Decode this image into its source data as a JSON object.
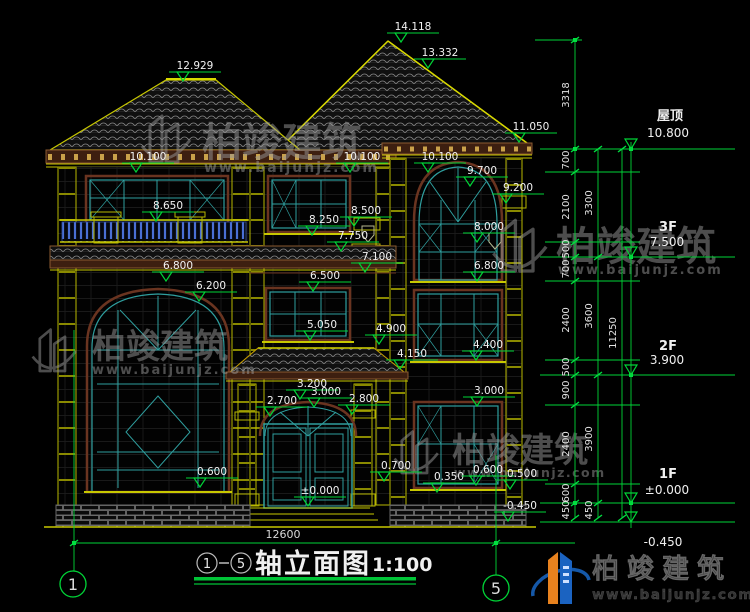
{
  "drawing": {
    "title": "轴立面图",
    "scale": "1:100",
    "axis_start": "1",
    "axis_end": "5",
    "total_width": "12600"
  },
  "levels": [
    {
      "name": "屋顶",
      "value": "10.800"
    },
    {
      "name": "3F",
      "value": "7.500"
    },
    {
      "name": "2F",
      "value": "3.900"
    },
    {
      "name": "1F",
      "value": "±0.000"
    },
    {
      "name": "",
      "value": "-0.450"
    }
  ],
  "markers": [
    "12.929",
    "14.118",
    "13.332",
    "11.050",
    "10.100",
    "10.100",
    "10.100",
    "9.700",
    "9.200",
    "8.650",
    "8.500",
    "8.250",
    "8.000",
    "7.750",
    "7.100",
    "6.800",
    "6.800",
    "6.500",
    "6.200",
    "5.050",
    "4.900",
    "4.400",
    "4.150",
    "3.200",
    "3.000",
    "2.700",
    "2.800",
    "3.000",
    "0.700",
    "0.600",
    "0.350",
    "0.600",
    "0.500",
    "±0.000",
    "-0.450"
  ],
  "chains": {
    "inner": [
      "3318",
      "700",
      "2100",
      "500",
      "700",
      "2400",
      "500",
      "900",
      "2400",
      "600",
      "450"
    ],
    "middle": [
      "3300",
      "3600",
      "3900",
      "450"
    ],
    "outer": [
      "11250"
    ]
  },
  "watermark": {
    "brand": "柏竣建筑",
    "url": "www.baijunjz.com"
  },
  "logo": {
    "brand": "柏竣建筑",
    "url": "www.baijunjz.com"
  },
  "colors": {
    "dim_green": "#00d437",
    "cad_yellow": "#c8c800",
    "frame_teal": "#2f9e9e",
    "trim_brown": "#8a5a30",
    "baluster_blue": "#4a6fd4",
    "logo_blue": "#1b63c1",
    "logo_orange": "#e8821e"
  }
}
